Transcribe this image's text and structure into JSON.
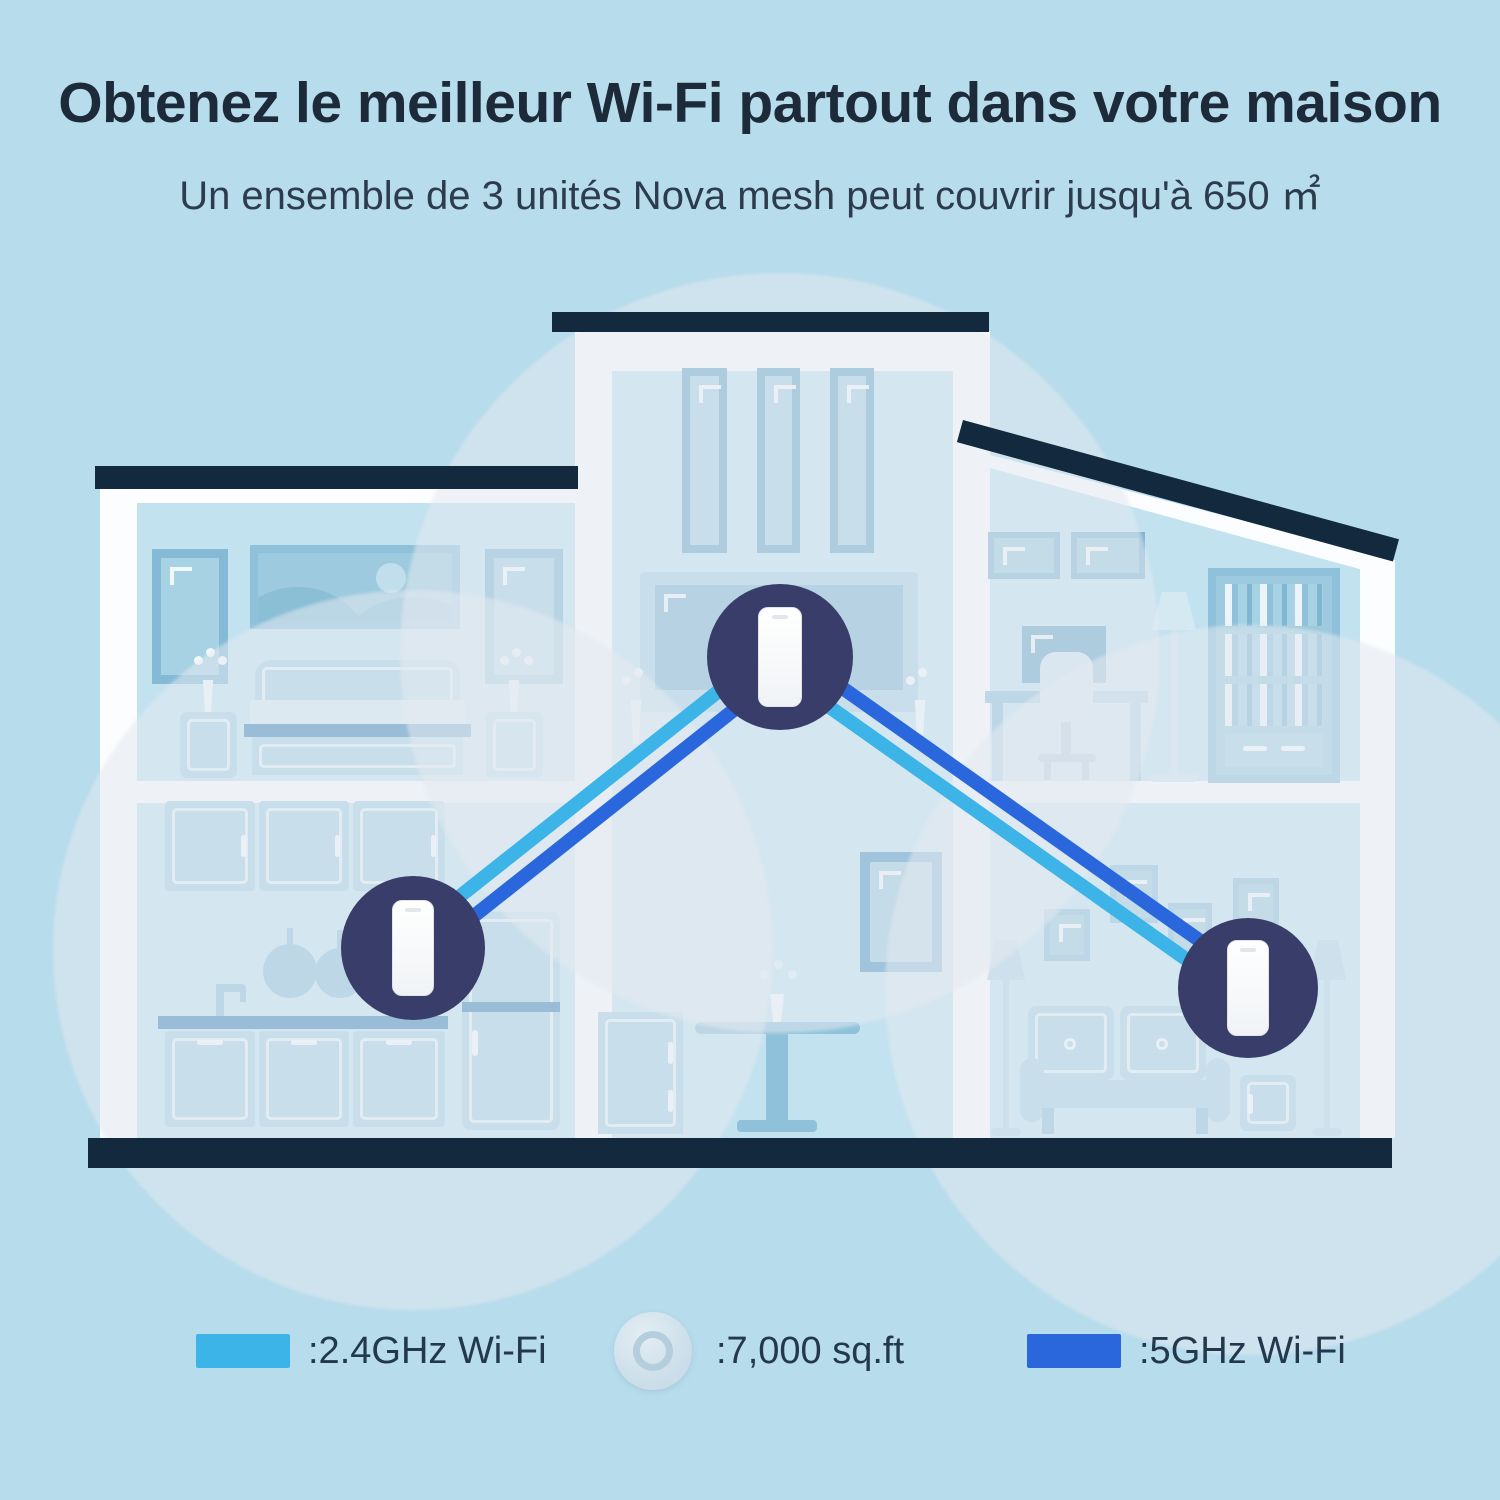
{
  "header": {
    "title": "Obtenez le meilleur Wi-Fi partout dans votre maison",
    "subtitle": "Un ensemble de 3 unités Nova mesh peut couvrir jusqu'à 650 ㎡"
  },
  "scene": {
    "unit_count": 3,
    "units": [
      "nova-unit-left",
      "nova-unit-center",
      "nova-unit-right"
    ],
    "connections": [
      {
        "from": "nova-unit-left",
        "to": "nova-unit-center",
        "bands": [
          "2.4GHz",
          "5GHz"
        ]
      },
      {
        "from": "nova-unit-center",
        "to": "nova-unit-right",
        "bands": [
          "2.4GHz",
          "5GHz"
        ]
      }
    ]
  },
  "legend": {
    "items": [
      {
        "label": ":2.4GHz Wi-Fi",
        "type": "swatch",
        "color": "#3db4e8"
      },
      {
        "label": ":7,000 sq.ft",
        "type": "coverage-icon"
      },
      {
        "label": ":5GHz Wi-Fi",
        "type": "swatch",
        "color": "#2a67dd"
      }
    ]
  },
  "colors": {
    "background": "#b7dcec",
    "structure_navy": "#13293e",
    "node_circle": "#393d6a",
    "wifi_2_4ghz": "#3db4e8",
    "wifi_5ghz": "#2a67dd",
    "coverage_circle": "rgba(228,234,240,0.55)"
  }
}
